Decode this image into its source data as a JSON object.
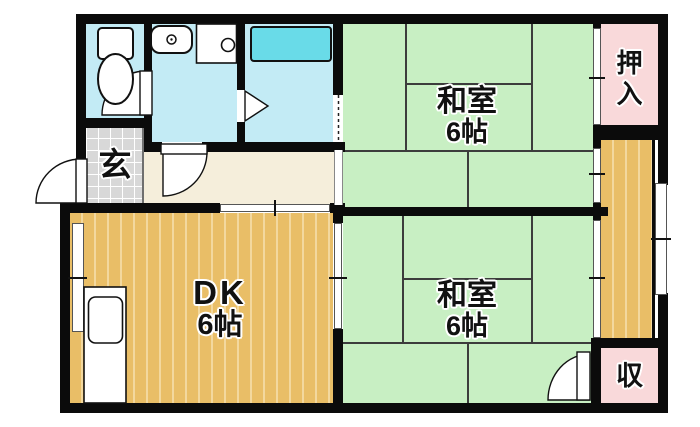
{
  "plan_title": "1DK apartment floor plan",
  "colors": {
    "wall": "#0b0b0b",
    "tatami_green": "#c8efc3",
    "wood_orange": "#e9be67",
    "wood_stripe": "#f3d89e",
    "wet_room_blue": "#c3ebf5",
    "bathtub_cyan": "#69dbe8",
    "closet_pink": "#f9d9da",
    "hallway_cream": "#f5eedb",
    "entry_gray": "#d8d8d8"
  },
  "rooms": {
    "washitsu_top": {
      "label": "和室",
      "size": "6帖"
    },
    "washitsu_bottom": {
      "label": "和室",
      "size": "6帖"
    },
    "dk": {
      "label": "DK",
      "size": "6帖"
    },
    "genkan": {
      "label": "玄"
    },
    "oshiire": {
      "label": "押入"
    },
    "storage": {
      "label": "収"
    }
  },
  "fixtures": {
    "toilet": "toilet",
    "washbasin": "washbasin",
    "washer_pan": "washing-machine-pan",
    "bathtub": "bathtub",
    "kitchen_counter": "kitchen-sink"
  }
}
